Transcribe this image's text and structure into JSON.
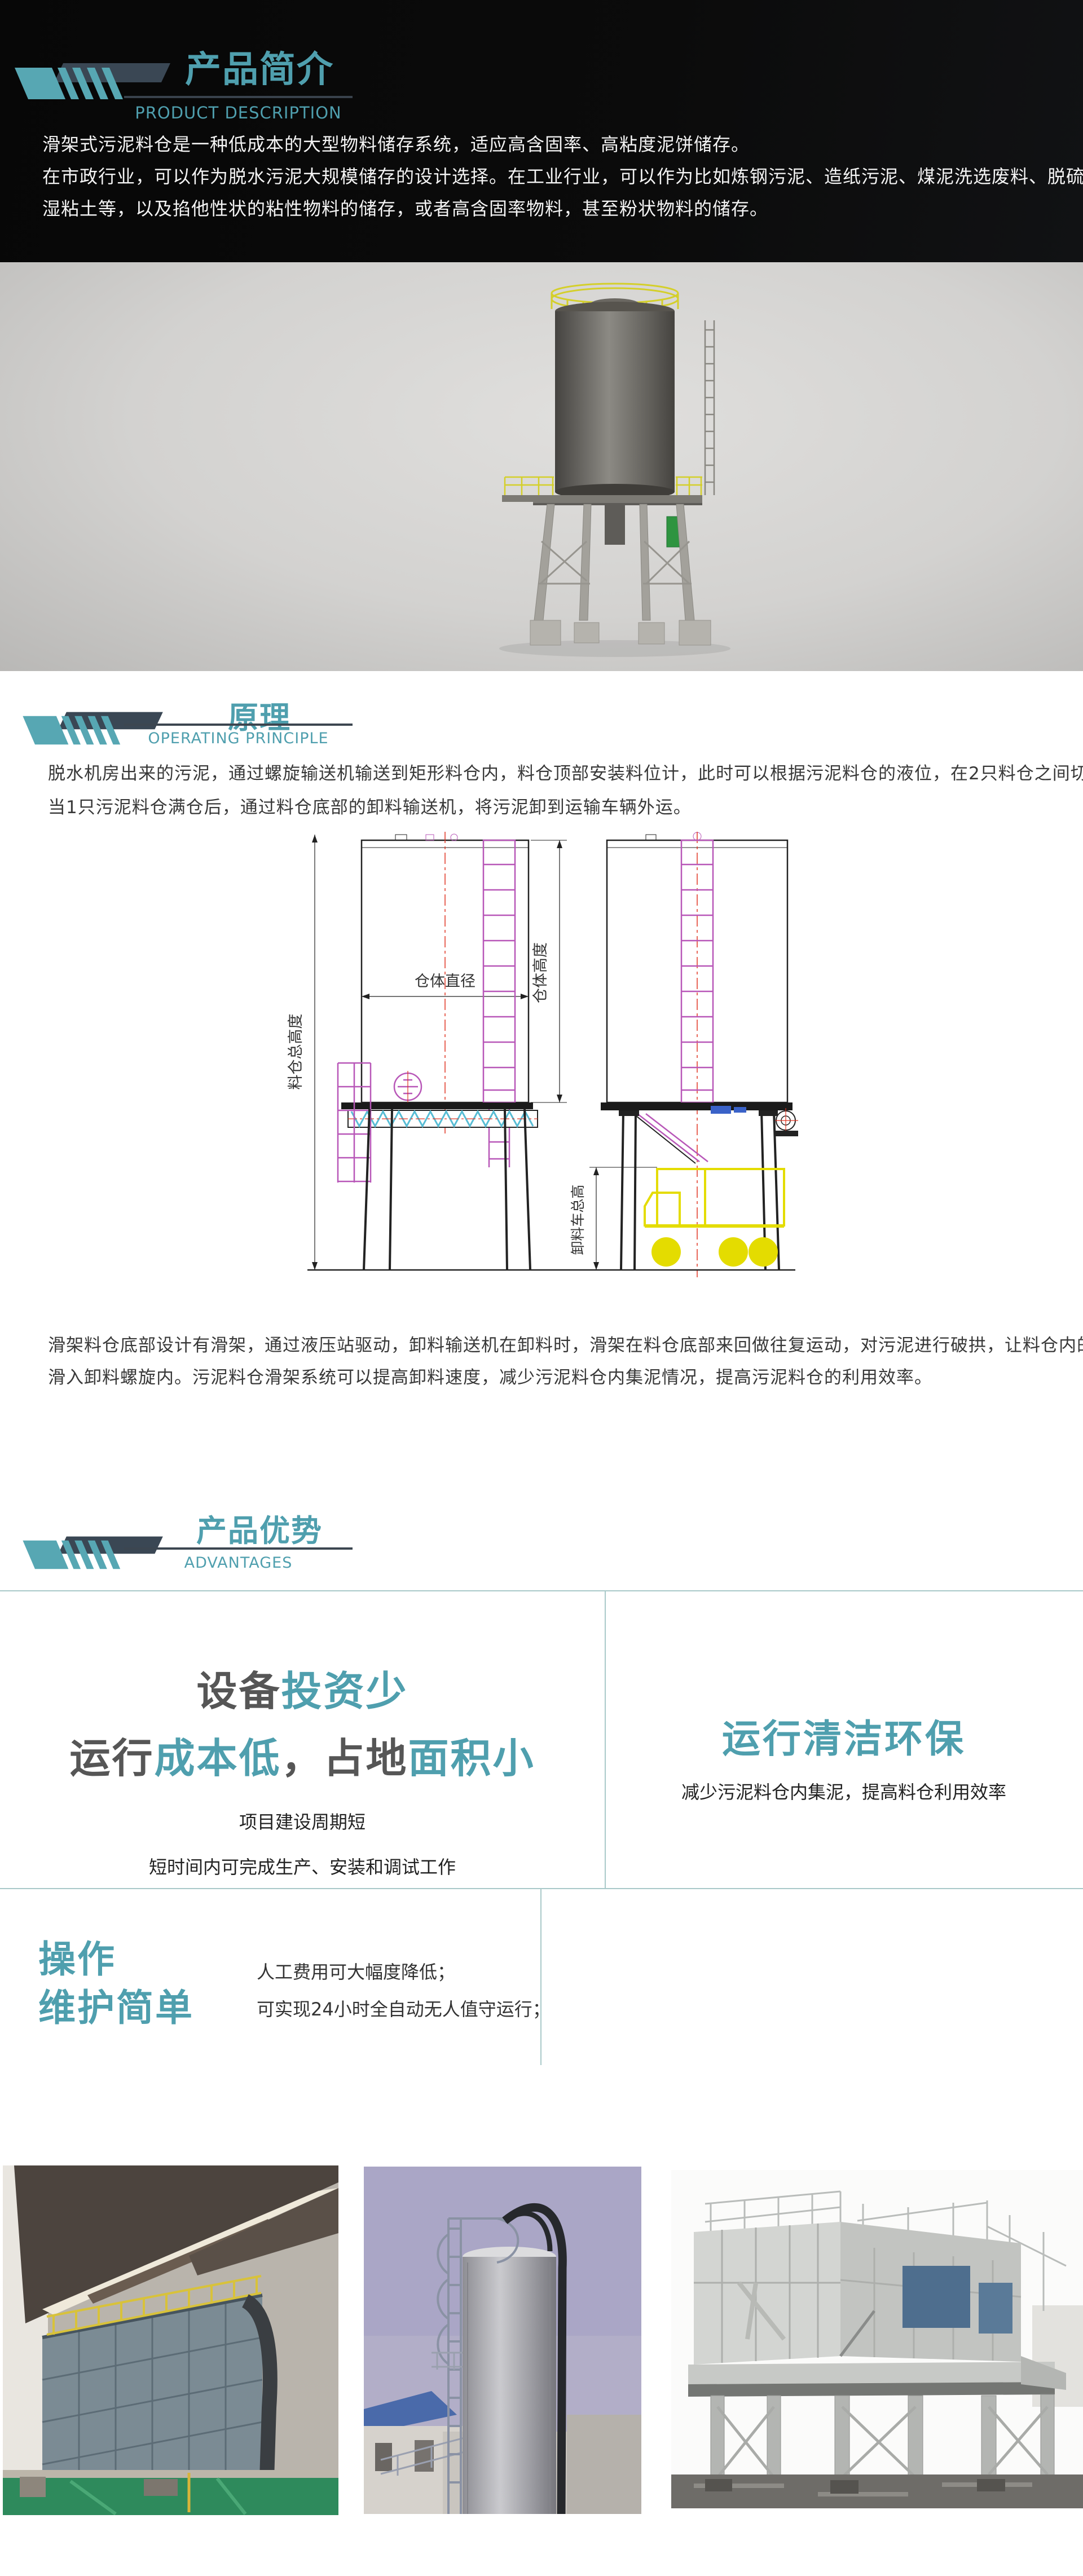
{
  "colors": {
    "accent_teal": "#4f9fae",
    "decoration_teal": "#57a7b3",
    "decoration_slate": "#3a4754",
    "table_border": "#a9c9c9",
    "intro_background": "#0b0b0b"
  },
  "intro": {
    "title": "产品简介",
    "subtitle": "PRODUCT DESCRIPTION",
    "lines": [
      "滑架式污泥料仓是一种低成本的大型物料储存系统，适应高含固率、高粘度泥饼储存。",
      "在市政行业，可以作为脱水污泥大规模储存的设计选择。在工业行业，可以作为比如炼钢污泥、造纸污泥、煤泥洗选废料、脱硫石膏、",
      "湿粘土等，以及掐他性状的粘性物料的储存，或者高含固率物料，甚至粉状物料的储存。"
    ]
  },
  "render": {
    "description_icon": "sludge-silo-3d-render"
  },
  "principle": {
    "title": "原理",
    "subtitle": "OPERATING PRINCIPLE",
    "paragraph1_lines": [
      "脱水机房出来的污泥，通过螺旋输送机输送到矩形料仓内，料仓顶部安装料位计，此时可以根据污泥料仓的液位，在2只料仓之间切换。",
      "当1只污泥料仓满仓后，通过料仓底部的卸料输送机，将污泥卸到运输车辆外运。"
    ],
    "drawing": {
      "silo_diameter": "仓体直径",
      "silo_height": "仓体高度",
      "total_height": "料仓总高度",
      "truck_height": "卸料车总高"
    },
    "paragraph2_lines": [
      "滑架料仓底部设计有滑架，通过液压站驱动，卸料输送机在卸料时，滑架在料仓底部来回做往复运动，对污泥进行破拱，让料仓内的污泥",
      "滑入卸料螺旋内。污泥料仓滑架系统可以提高卸料速度，减少污泥料仓内集泥情况，提高污泥料仓的利用效率。"
    ]
  },
  "advantages": {
    "title": "产品优势",
    "subtitle": "ADVANTAGES",
    "cell_investment": {
      "line1": [
        {
          "text": "设备",
          "c": "dark"
        },
        {
          "text": "投资少",
          "c": "teal"
        }
      ],
      "line2": [
        {
          "text": "运行",
          "c": "dark"
        },
        {
          "text": "成本低",
          "c": "teal"
        },
        {
          "text": "，",
          "c": "dark"
        },
        {
          "text": "占地",
          "c": "dark"
        },
        {
          "text": "面积小",
          "c": "teal"
        }
      ],
      "sub1": "项目建设周期短",
      "sub2": "短时间内可完成生产、安装和调试工作"
    },
    "cell_clean": {
      "heading": "运行清洁环保",
      "sub": "减少污泥料仓内集泥，提高料仓利用效率"
    },
    "cell_operation": {
      "heading_line1": "操作",
      "heading_line2": "维护简单",
      "sub1": "人工费用可大幅度降低；",
      "sub2": "可实现24小时全自动无人值守运行；"
    }
  },
  "photos": [
    {
      "name": "indoor-rectangular-silo-photo"
    },
    {
      "name": "cylindrical-silo-photo"
    },
    {
      "name": "outdoor-silo-structure-photo"
    }
  ]
}
